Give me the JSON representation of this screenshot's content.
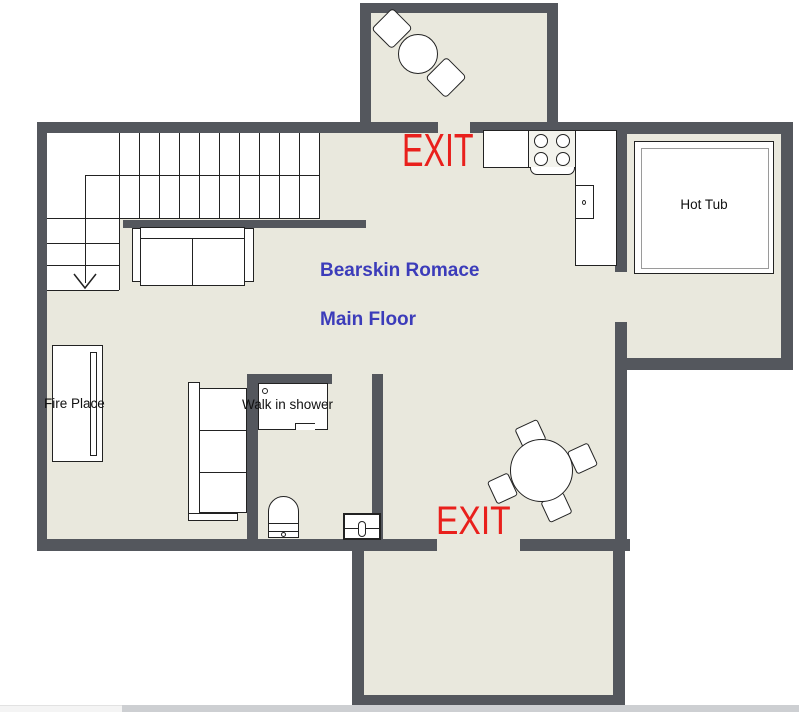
{
  "plan": {
    "title_line1": "Bearskin Romace",
    "title_line2": "Main Floor",
    "exits": {
      "top": "EXIT",
      "bottom": "EXIT"
    },
    "rooms": {
      "hot_tub_label": "Hot Tub",
      "fire_place_label": "Fire Place",
      "shower_label": "Walk in shower"
    },
    "colors": {
      "wall": "#54575d",
      "floor": "#e9e8dd",
      "exit_red": "#e9201c",
      "title_blue": "#3c3cba",
      "line": "#222222"
    }
  }
}
